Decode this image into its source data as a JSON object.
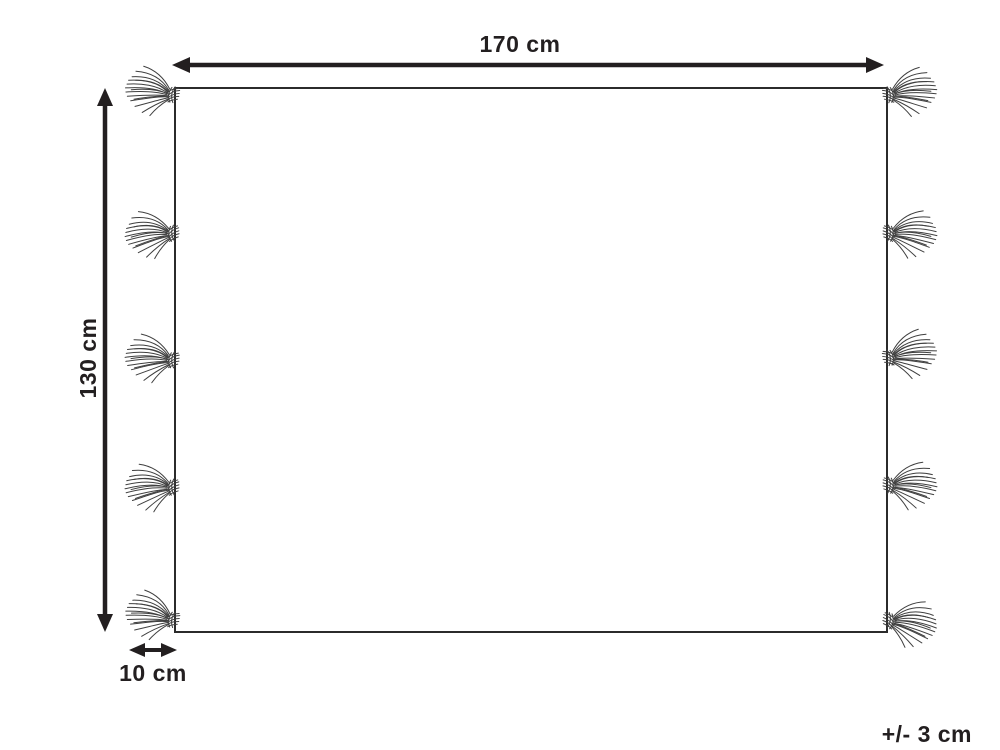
{
  "diagram": {
    "kind": "product-dimension-diagram",
    "labels": {
      "width": "170 cm",
      "height": "130 cm",
      "fringe": "10 cm",
      "tolerance": "+/- 3 cm"
    },
    "tassels_per_side": 5,
    "colors": {
      "line": "#231f20",
      "outline": "#2b2b2b",
      "tassel": "#3f3f3f",
      "background": "#ffffff"
    }
  }
}
